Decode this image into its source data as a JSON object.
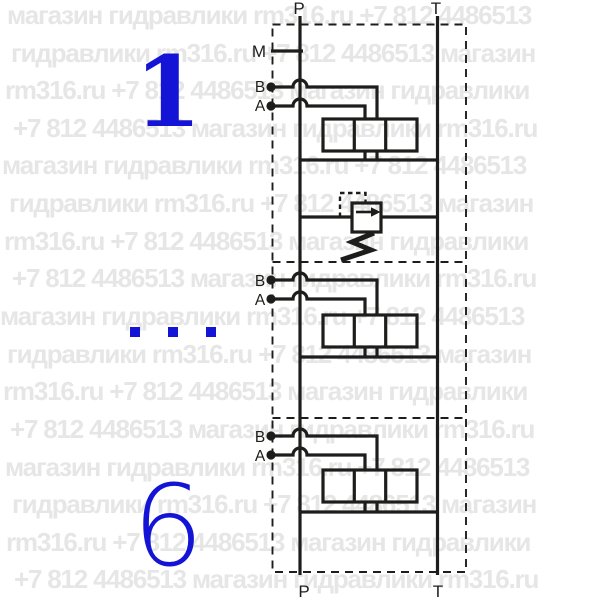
{
  "watermark": {
    "color": "#e6e6e6",
    "rows": [
      "магазин гидравлики rm316.ru +7 812 4486513",
      "гидравлики rm316.ru +7 812 4486513 магазин",
      "rm316.ru +7 812 4486513 магазин гидравлики",
      "+7 812 4486513 магазин гидравлики rm316.ru",
      "магазин гидравлики rm316.ru +7 812 4486513",
      "гидравлики rm316.ru +7 812 4486513 магазин",
      "rm316.ru +7 812 4486513 магазин гидравлики",
      "+7 812 4486513 магазин гидравлики rm316.ru",
      "магазин гидравлики rm316.ru +7 812 4486513",
      "гидравлики rm316.ru +7 812 4486513 магазин",
      "rm316.ru +7 812 4486513 магазин гидравлики",
      "+7 812 4486513 магазин гидравлики rm316.ru",
      "магазин гидравлики rm316.ru +7 812 4486513",
      "гидравлики rm316.ru +7 812 4486513 магазин",
      "rm316.ru +7 812 4486513 магазин гидравлики",
      "+7 812 4486513 магазин гидравлики rm316.ru"
    ]
  },
  "schematic": {
    "line_color": "#1d1d1b",
    "accent_color": "#1414d6",
    "top_ports": {
      "p": "P",
      "t": "T"
    },
    "bottom_ports": {
      "p": "P",
      "t": "T"
    },
    "gauge_port": "M",
    "sections": [
      {
        "number": "1",
        "port_b": "B",
        "port_a": "A",
        "has_relief_valve": true
      },
      {
        "number": "...",
        "port_b": "B",
        "port_a": "A",
        "has_relief_valve": false
      },
      {
        "number": "6",
        "port_b": "B",
        "port_a": "A",
        "has_relief_valve": false
      }
    ]
  }
}
